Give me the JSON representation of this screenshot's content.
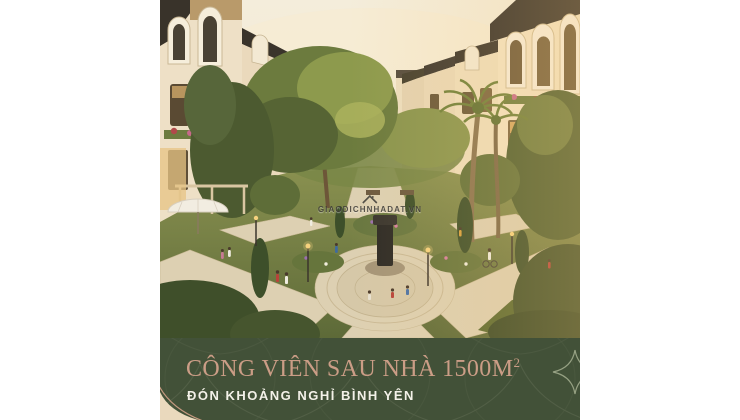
{
  "poster": {
    "banner": {
      "title_main": "CÔNG VIÊN SAU NHÀ 1500M",
      "title_sup": "2",
      "title_full": "CÔNG VIÊN SAU NHÀ 1500M²",
      "subtitle": "ĐÓN KHOẢNG NGHỈ BÌNH YÊN"
    },
    "watermark": {
      "text": "GIAODICHNHADAT.VN",
      "icon": "house-roof-icon"
    },
    "colors": {
      "page_margin": "#ffffff",
      "banner_background": "#425138",
      "banner_pattern_line": "#56634a",
      "banner_ornament_rose": "#c59a80",
      "banner_corner_cream": "#ead9bd",
      "banner_star_line": "#96a183",
      "title_text": "#cb9d86",
      "subtitle_text": "#f3f1e8",
      "watermark_text": "#3e3b36",
      "sky": "#f2ebd8",
      "townhouse_cream": "#efe2ca",
      "roof_dark": "#39332a",
      "foliage_dark": "#4c5a30",
      "foliage_light": "#8d9a4d",
      "path_stone": "#ddd0b2"
    },
    "scene_description": "Golden-hour 3D render of a landscaped back-of-house park with winding stone paths, a central fountain plaza, palms and cypresses between two rows of cream mansard-roof shophouses"
  }
}
